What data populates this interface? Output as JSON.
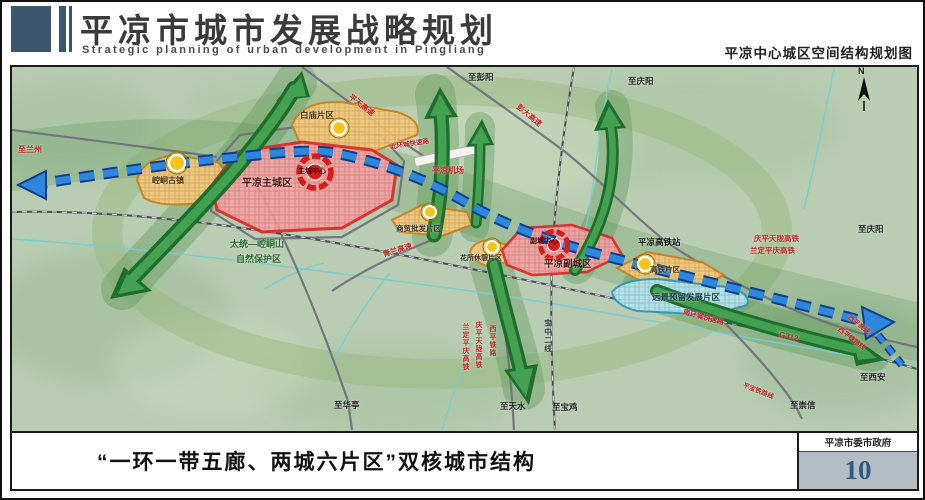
{
  "header": {
    "title": "平凉市城市发展战略规划",
    "subtitle": "Strategic planning of urban development in Pingliang",
    "map_title": "平凉中心城区空间结构规划图"
  },
  "map": {
    "compass": "N",
    "labels": [
      {
        "id": "to-lanzhou",
        "text": "至兰州"
      },
      {
        "id": "baimiao-district",
        "text": "白庙片区"
      },
      {
        "id": "pingtian-expressway",
        "text": "平天高速"
      },
      {
        "id": "to-pengyang",
        "text": "至彭阳"
      },
      {
        "id": "pengda-expressway",
        "text": "彭大高速"
      },
      {
        "id": "to-qingyang-north",
        "text": "至庆阳"
      },
      {
        "id": "main-city",
        "text": "平凉主城区"
      },
      {
        "id": "main-city-center",
        "text": "主城中心"
      },
      {
        "id": "north-ring-road",
        "text": "北环城快速路"
      },
      {
        "id": "pingliang-airport",
        "text": "平凉机场"
      },
      {
        "id": "nature-reserve-line1",
        "text": "太统—崆峒山"
      },
      {
        "id": "nature-reserve-line2",
        "text": "自然保护区"
      },
      {
        "id": "kongtong-town",
        "text": "崆峒古镇"
      },
      {
        "id": "commerce-district",
        "text": "商贸批发片区"
      },
      {
        "id": "qinglan-expressway",
        "text": "青兰高速"
      },
      {
        "id": "huasuo-leisure-district",
        "text": "花所休憩片区"
      },
      {
        "id": "sub-city-center",
        "text": "副城中心"
      },
      {
        "id": "sub-city",
        "text": "平凉副城区"
      },
      {
        "id": "hsr-station",
        "text": "平凉高铁站"
      },
      {
        "id": "qingpingtianlong-hsr",
        "text": "庆平天陇高铁"
      },
      {
        "id": "landingpingqing-hsr",
        "text": "兰定平庆高铁"
      },
      {
        "id": "to-qingyang-east",
        "text": "至庆阳"
      },
      {
        "id": "hsr-district",
        "text": "高铁片区"
      },
      {
        "id": "reserved-development-district",
        "text": "远景预留发展片区"
      },
      {
        "id": "south-ring-road",
        "text": "南环城快速路"
      },
      {
        "id": "g312",
        "text": "G312"
      },
      {
        "id": "xiping-expressway",
        "text": "西平高速"
      },
      {
        "id": "xiping-railway-line",
        "text": "西平铁路线"
      },
      {
        "id": "to-xian",
        "text": "至西安"
      },
      {
        "id": "landingpingqing-hsr-vertical",
        "text": "兰定平庆高铁"
      },
      {
        "id": "qingpingtianlong-hsr-vertical",
        "text": "庆平天陇高铁"
      },
      {
        "id": "xiping-railway-vertical",
        "text": "西平铁路"
      },
      {
        "id": "baozhong-line2",
        "text": "宝中二线"
      },
      {
        "id": "to-huating",
        "text": "至华亭"
      },
      {
        "id": "to-tianshui",
        "text": "至天水"
      },
      {
        "id": "to-baoji",
        "text": "至宝鸡"
      },
      {
        "id": "to-chongxin",
        "text": "至崇信"
      },
      {
        "id": "pingbao-railway-line",
        "text": "平宝铁路线"
      }
    ]
  },
  "footer": {
    "caption": "“一环一带五廊、两城六片区”双核城市结构",
    "agency": "平凉市委市政府",
    "page_number": "10"
  },
  "colors": {
    "accent_blue": "#3b566e",
    "map_background": "#b9cdb2",
    "eco_green": "#2c7d39",
    "axis_blue": "#2f86dd",
    "city_red": "#dd2222",
    "district_orange": "#c8821a",
    "reserved_blue": "#2e96b8",
    "node_yellow": "#f6c51d",
    "page_number_bg": "#b3bdc6"
  }
}
